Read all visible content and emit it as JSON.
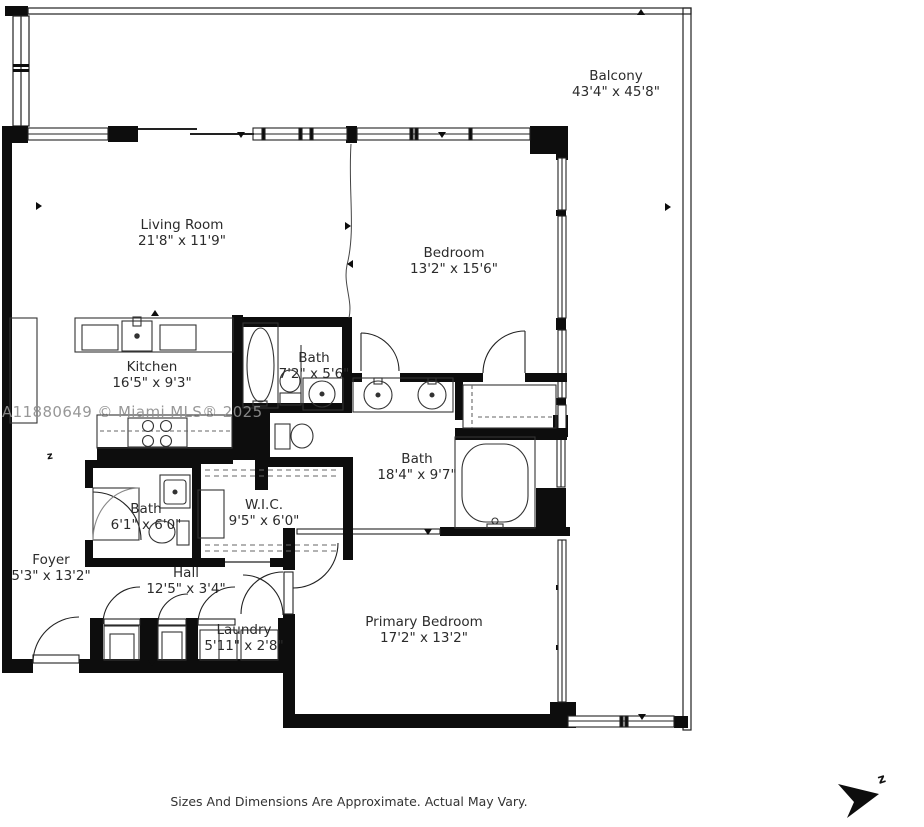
{
  "watermark": "A11880649 © Miami MLS® 2025",
  "footer": {
    "disclaimer": "Sizes And Dimensions Are Approximate. Actual May Vary."
  },
  "compass": {
    "label": "z"
  },
  "plan": {
    "orientation_marker": "z"
  },
  "rooms": {
    "balcony": {
      "name": "Balcony",
      "dims": "43'4\" x 45'8\""
    },
    "living_room": {
      "name": "Living Room",
      "dims": "21'8\" x 11'9\""
    },
    "bedroom": {
      "name": "Bedroom",
      "dims": "13'2\" x 15'6\""
    },
    "kitchen": {
      "name": "Kitchen",
      "dims": "16'5\" x 9'3\""
    },
    "bath_2": {
      "name": "Bath",
      "dims": "7'2\" x 5'6\""
    },
    "bath_primary": {
      "name": "Bath",
      "dims": "18'4\" x 9'7\""
    },
    "bath_3": {
      "name": "Bath",
      "dims": "6'1\" x 6'0\""
    },
    "wic": {
      "name": "W.I.C.",
      "dims": "9'5\" x 6'0\""
    },
    "foyer": {
      "name": "Foyer",
      "dims": "5'3\" x 13'2\""
    },
    "hall": {
      "name": "Hall",
      "dims": "12'5\" x 3'4\""
    },
    "laundry": {
      "name": "Laundry",
      "dims": "5'11\" x 2'8\""
    },
    "primary_bedroom": {
      "name": "Primary Bedroom",
      "dims": "17'2\" x 13'2\""
    }
  }
}
